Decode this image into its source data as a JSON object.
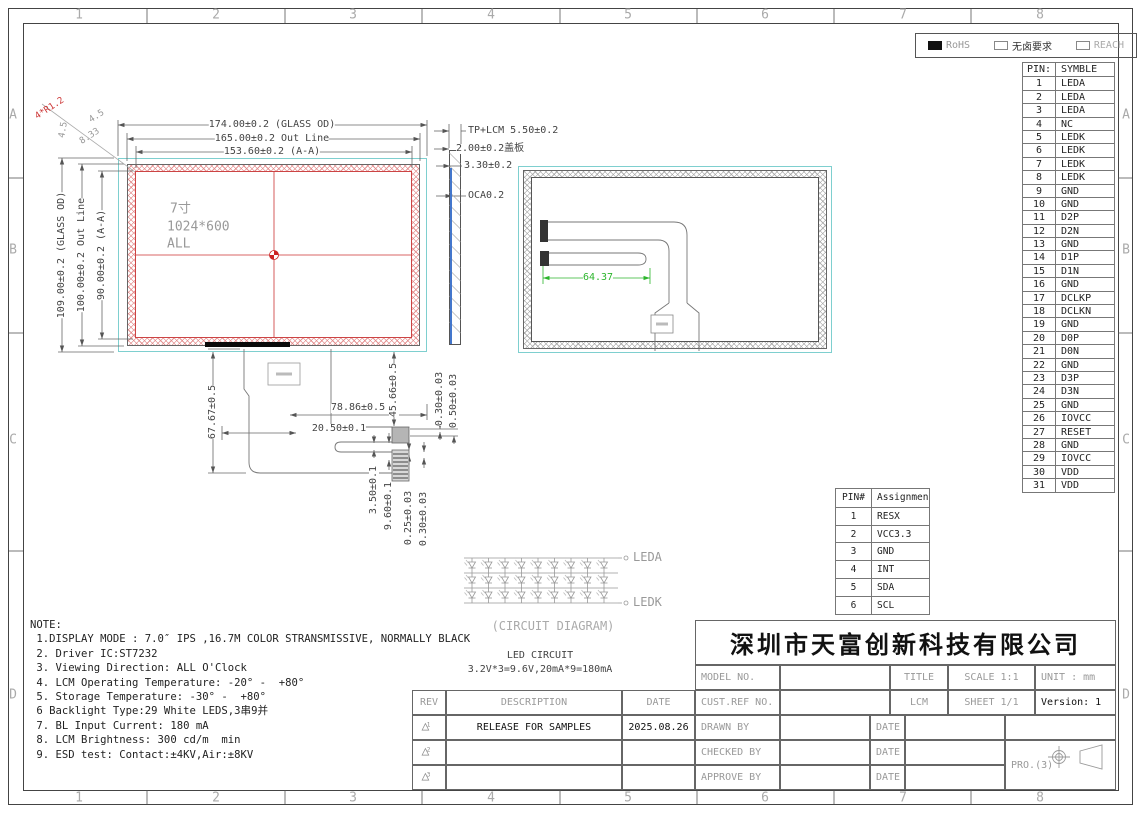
{
  "border": {
    "cols": [
      "1",
      "2",
      "3",
      "4",
      "5",
      "6",
      "7",
      "8"
    ],
    "rows": [
      "A",
      "B",
      "C",
      "D"
    ]
  },
  "compliance": {
    "items": [
      {
        "label": "RoHS",
        "checked": true,
        "color": "#999"
      },
      {
        "label": "无卤要求",
        "checked": false,
        "color": "#333"
      },
      {
        "label": "REACH",
        "checked": false,
        "color": "#aaa"
      }
    ]
  },
  "pin_table": {
    "headers": [
      "PIN:",
      "SYMBLE"
    ],
    "rows": [
      [
        "1",
        "LEDA"
      ],
      [
        "2",
        "LEDA"
      ],
      [
        "3",
        "LEDA"
      ],
      [
        "4",
        "NC"
      ],
      [
        "5",
        "LEDK"
      ],
      [
        "6",
        "LEDK"
      ],
      [
        "7",
        "LEDK"
      ],
      [
        "8",
        "LEDK"
      ],
      [
        "9",
        "GND"
      ],
      [
        "10",
        "GND"
      ],
      [
        "11",
        "D2P"
      ],
      [
        "12",
        "D2N"
      ],
      [
        "13",
        "GND"
      ],
      [
        "14",
        "D1P"
      ],
      [
        "15",
        "D1N"
      ],
      [
        "16",
        "GND"
      ],
      [
        "17",
        "DCLKP"
      ],
      [
        "18",
        "DCLKN"
      ],
      [
        "19",
        "GND"
      ],
      [
        "20",
        "D0P"
      ],
      [
        "21",
        "D0N"
      ],
      [
        "22",
        "GND"
      ],
      [
        "23",
        "D3P"
      ],
      [
        "24",
        "D3N"
      ],
      [
        "25",
        "GND"
      ],
      [
        "26",
        "IOVCC"
      ],
      [
        "27",
        "RESET"
      ],
      [
        "28",
        "GND"
      ],
      [
        "29",
        "IOVCC"
      ],
      [
        "30",
        "VDD"
      ],
      [
        "31",
        "VDD"
      ]
    ]
  },
  "tp_pin_table": {
    "headers": [
      "PIN#",
      "Assignment"
    ],
    "rows": [
      [
        "1",
        "RESX"
      ],
      [
        "2",
        "VCC3.3"
      ],
      [
        "3",
        "GND"
      ],
      [
        "4",
        "INT"
      ],
      [
        "5",
        "SDA"
      ],
      [
        "6",
        "SCL"
      ]
    ]
  },
  "labels": [
    {
      "t": "174.00±0.2 (GLASS OD)",
      "x": 272,
      "y": 125,
      "bg": 1
    },
    {
      "t": "165.00±0.2 Out Line",
      "x": 272,
      "y": 139,
      "bg": 1
    },
    {
      "t": "153.60±0.2 (A-A)",
      "x": 272,
      "y": 152,
      "bg": 1
    },
    {
      "t": "TP+LCM 5.50±0.2",
      "x": 468,
      "y": 131,
      "a": "left",
      "bg": 1
    },
    {
      "t": "2.00±0.2盖板",
      "x": 456,
      "y": 149,
      "a": "left",
      "bg": 1
    },
    {
      "t": "3.30±0.2",
      "x": 464,
      "y": 166,
      "a": "left",
      "bg": 1
    },
    {
      "t": "OCA0.2",
      "x": 468,
      "y": 196,
      "a": "left",
      "bg": 1
    },
    {
      "t": "109.00±0.2 (GLASS OD)",
      "x": 62,
      "y": 255,
      "r": -90,
      "bg": 1
    },
    {
      "t": "100.00±0.2 Out Line",
      "x": 82,
      "y": 255,
      "r": -90,
      "bg": 1
    },
    {
      "t": "90.00±0.2 (A-A)",
      "x": 102,
      "y": 255,
      "r": -90,
      "bg": 1
    },
    {
      "t": "4*R1.2",
      "x": 50,
      "y": 109,
      "r": -33,
      "c": "#cc3333",
      "fs": 9
    },
    {
      "t": "4.5",
      "x": 97,
      "y": 117,
      "r": -33,
      "c": "#999",
      "fs": 9
    },
    {
      "t": "8.33",
      "x": 90,
      "y": 137,
      "r": -33,
      "c": "#999",
      "fs": 9
    },
    {
      "t": "4.5",
      "x": 64,
      "y": 130,
      "r": -80,
      "c": "#999",
      "fs": 9
    },
    {
      "t": "67.67±0.5",
      "x": 213,
      "y": 412,
      "r": -90,
      "bg": 1
    },
    {
      "t": "45.66±0.5",
      "x": 394,
      "y": 390,
      "r": -90,
      "bg": 1
    },
    {
      "t": "78.86±0.5",
      "x": 358,
      "y": 408,
      "bg": 1
    },
    {
      "t": "20.50±0.1",
      "x": 339,
      "y": 429,
      "bg": 1
    },
    {
      "t": "3.50±0.1",
      "x": 374,
      "y": 490,
      "r": -90,
      "bg": 1
    },
    {
      "t": "9.60±0.1",
      "x": 389,
      "y": 506,
      "r": -90,
      "bg": 1
    },
    {
      "t": "0.25±0.03",
      "x": 409,
      "y": 518,
      "r": -90,
      "bg": 1
    },
    {
      "t": "0.30±0.03",
      "x": 424,
      "y": 519,
      "r": -90,
      "bg": 1
    },
    {
      "t": "0.30±0.03",
      "x": 440,
      "y": 399,
      "r": -90,
      "bg": 1
    },
    {
      "t": "0.50±0.03",
      "x": 454,
      "y": 401,
      "r": -90,
      "bg": 1
    },
    {
      "t": "64.37",
      "x": 598,
      "y": 278,
      "c": "#2cb52c",
      "bg": 1
    },
    {
      "t": "7寸",
      "x": 170,
      "y": 209,
      "c": "#999",
      "a": "left",
      "fs": 13
    },
    {
      "t": "1024*600",
      "x": 167,
      "y": 227,
      "c": "#999",
      "a": "left",
      "fs": 13
    },
    {
      "t": "ALL",
      "x": 167,
      "y": 244,
      "c": "#999",
      "a": "left",
      "fs": 13
    },
    {
      "t": "LEDA",
      "x": 633,
      "y": 557,
      "c": "#999",
      "a": "left",
      "fs": 12
    },
    {
      "t": "LEDK",
      "x": 633,
      "y": 602,
      "c": "#999",
      "a": "left",
      "fs": 12
    },
    {
      "t": "(CIRCUIT DIAGRAM)",
      "x": 553,
      "y": 626,
      "c": "#aaa",
      "fs": 12
    },
    {
      "t": "LED CIRCUIT",
      "x": 540,
      "y": 656
    },
    {
      "t": "3.2V*3=9.6V,20mA*9=180mA",
      "x": 540,
      "y": 670
    }
  ],
  "circuit": {
    "rows": 3,
    "cols": 9
  },
  "notes": [
    "NOTE:",
    " 1.DISPLAY MODE : 7.0″ IPS ,16.7M COLOR STRANSMISSIVE, NORMALLY BLACK",
    " 2. Driver IC:ST7232",
    " 3. Viewing Direction: ALL O'Clock",
    " 4. LCM Operating Temperature: -20° -  +80°",
    " 5. Storage Temperature: -30° -  +80°",
    " 6 Backlight Type:29 White LEDS,3串9并",
    " 7. BL Input Current: 180 mA",
    " 8. LCM Brightness: 300 cd/m  min",
    " 9. ESD test: Contact:±4KV,Air:±8KV"
  ],
  "rev_table": {
    "headers": [
      "REV",
      "DESCRIPTION",
      "DATE"
    ],
    "rows": [
      {
        "sym": "1",
        "desc": "RELEASE FOR SAMPLES",
        "date": "2025.08.26"
      },
      {
        "sym": "2",
        "desc": "",
        "date": ""
      },
      {
        "sym": "3",
        "desc": "",
        "date": ""
      }
    ]
  },
  "title_block": {
    "company": "深圳市天富创新科技有限公司",
    "model_no": "MODEL NO.",
    "cust_ref": "CUST.REF NO.",
    "title": "TITLE",
    "lcm": "LCM",
    "scale": "SCALE 1:1",
    "sheet": "SHEET 1/1",
    "unit": "UNIT : mm",
    "version": "Version: 1",
    "drawn": "DRAWN BY",
    "checked": "CHECKED BY",
    "approved": "APPROVE BY",
    "date": "DATE",
    "projection": "PRO.(3)"
  }
}
